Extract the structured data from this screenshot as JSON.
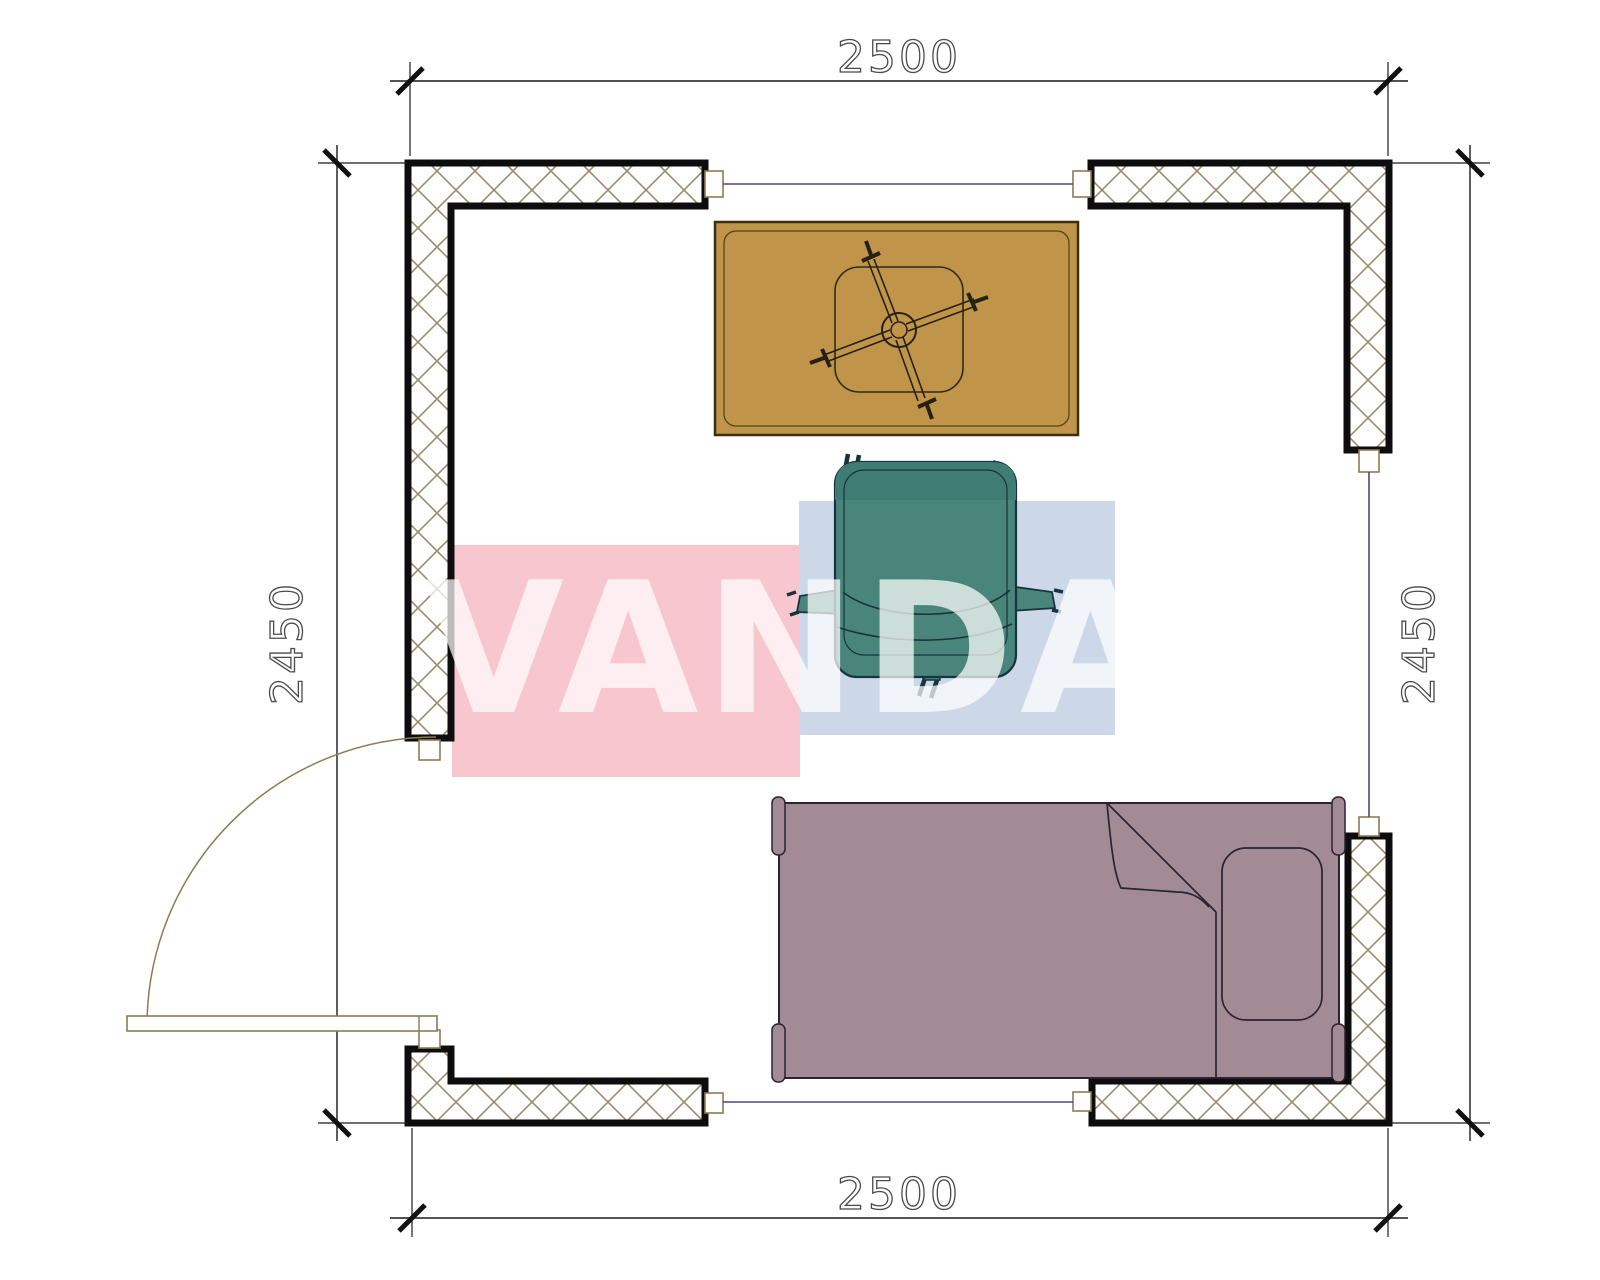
{
  "page": {
    "type": "room-floor-plan",
    "background": "#ffffff"
  },
  "dimensions": {
    "top": "2500",
    "bottom": "2500",
    "left": "2450",
    "right": "2450"
  },
  "watermark": {
    "text": "VANDA",
    "pink_color": "#f8c6ce",
    "blue_color": "#ccd8e8",
    "text_color": "rgba(255,255,255,0.72)"
  },
  "colors": {
    "wall_outline": "#0d0d0d",
    "wall_hatch": "#9a8c6e",
    "table": "#c0954a",
    "table_outline": "#3a2f10",
    "chair": "#4a857c",
    "chair_dark": "#3f7d74",
    "chair_outline": "#17343c",
    "bed": "#a28b95",
    "bed_outline": "#2c2231",
    "door": "#8d7b52",
    "opening_line": "#4a4a78",
    "dimension_line": "#1a1a1a",
    "dimension_text": "#4a4a4a"
  },
  "furniture": [
    {
      "name": "desk-table"
    },
    {
      "name": "desk-chair-base"
    },
    {
      "name": "office-chair"
    },
    {
      "name": "single-bed"
    },
    {
      "name": "door"
    }
  ]
}
